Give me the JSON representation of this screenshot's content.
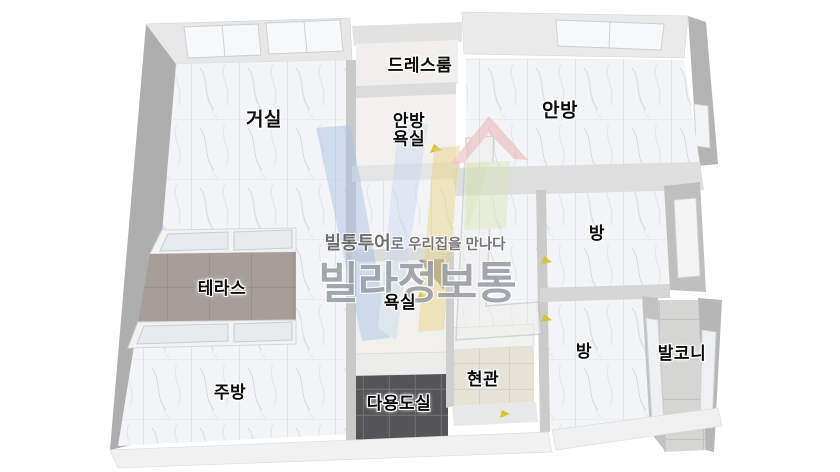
{
  "brand": {
    "slogan_bold": "빌통투어",
    "slogan_rest": "로 우리집을 만나다",
    "name": "빌라정보통"
  },
  "rooms": {
    "dressroom": {
      "label": "드레스룸"
    },
    "living": {
      "label": "거실"
    },
    "master_bath": {
      "line1": "안방",
      "line2": "욕실"
    },
    "master": {
      "label": "안방"
    },
    "room_right": {
      "label": "방"
    },
    "terrace": {
      "label": "테라스"
    },
    "bath": {
      "label": "욕실"
    },
    "kitchen": {
      "label": "주방"
    },
    "utility": {
      "label": "다용도실"
    },
    "entrance": {
      "label": "현관"
    },
    "room_bottom": {
      "label": "방"
    },
    "balcony": {
      "label": "발코니"
    }
  },
  "colors": {
    "background": "#ffffff",
    "floor_marble": "#f3f4f6",
    "marble_vein": "#c9cdd7",
    "floor_dark_tile": "#555557",
    "floor_terrace": "#a89e99",
    "floor_entrance": "#e7e2d6",
    "floor_balcony": "#d5d5d3",
    "wall_outer": "#aeaeae",
    "wall_top": "#e9e9e9",
    "window_glass": "#e8ebee",
    "door_mark_yellow": "#d9c23a",
    "logo_blue": "#a3c1e6",
    "logo_yellow": "#e9d27e",
    "logo_roof_red": "#e9a6a6",
    "logo_house_green": "#dbe6ba",
    "slogan_text": "#636363",
    "brand_text": "#9ba1a8",
    "room_label_text": "#0b0b0b"
  }
}
